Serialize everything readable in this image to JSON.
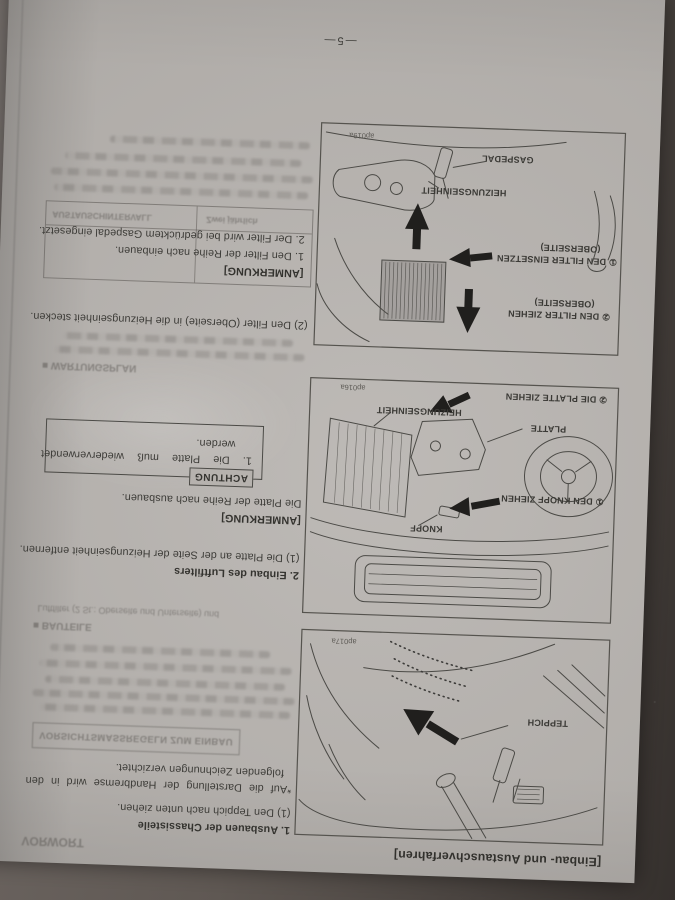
{
  "page": {
    "number": "—5—",
    "heading": "[Einbau- und Austauschverfahren]",
    "sections": [
      {
        "title": "1. Ausbauen der Chassisteile",
        "step1": "(1) Den Teppich nach unten ziehen.",
        "note": "*Auf die Darstellung der Handbremse wird in den folgenden Zeichnungen verzichtet."
      },
      {
        "title": "2. Einbau des Luftfilters",
        "step1": "(1) Die Platte an der Seite der Heizungseinheit entfernen.",
        "anmerkung_label": "[ANMERKUNG]",
        "anmerkung": "Die Platte der Reihe nach ausbauen.",
        "achtung_label": "ACHTUNG",
        "achtung": "1.  Die Platte muß wiederverwendet werden.",
        "step2": "(2) Den Filter (Oberseite) in die Heizungseinheit stecken.",
        "anmerkung2_label": "[ANMERKUNG]",
        "anmerkung2_item1": "1. Den Filter der Reihe nach einbauen.",
        "anmerkung2_item2": "2. Der Filter wird bei gedrücktem Gaspedal eingesetzt."
      }
    ]
  },
  "figures": {
    "carpet": {
      "code": "ap017a",
      "labels": {
        "teppich": "TEPPICH"
      }
    },
    "plate": {
      "code": "ap016a",
      "labels": {
        "knopf": "KNOPF",
        "step1": "① DEN KNOPF ZIEHEN",
        "platte": "PLATTE",
        "heizung": "HEIZUNGSEINHEIT",
        "step2": "② DIE PLATTE ZIEHEN"
      }
    },
    "filter": {
      "code": "ap019a",
      "labels": {
        "step_pull": "② DEN FILTER ZIEHEN",
        "step_pull2": "(OBERSEITE)",
        "step_insert": "① DEN FILTER EINSETZEN",
        "step_insert2": "(OBERSEITE)",
        "heizung": "HEIZUNGSEINHEIT",
        "gaspedal": "GASPEDAL"
      }
    }
  },
  "bleedthrough": {
    "vorwort": "VORWORT",
    "caution_box": "VORSICHTSMASSREGELN ZUM EINBAU",
    "bauteile": "■ BAUTEILE",
    "luftfilter_line": "Luftfilter (2 St.: Oberseite und Unterseite) und",
    "wartungsplan": "■ WARTUNGSPLAN",
    "table_header_interval": "AUSTAUSCHINTERVALL",
    "table_header_twice": "Zwei jährlich"
  },
  "colors": {
    "paper": "#b6b2ae",
    "ink": "#3d3c38",
    "background": "#5f5853"
  }
}
